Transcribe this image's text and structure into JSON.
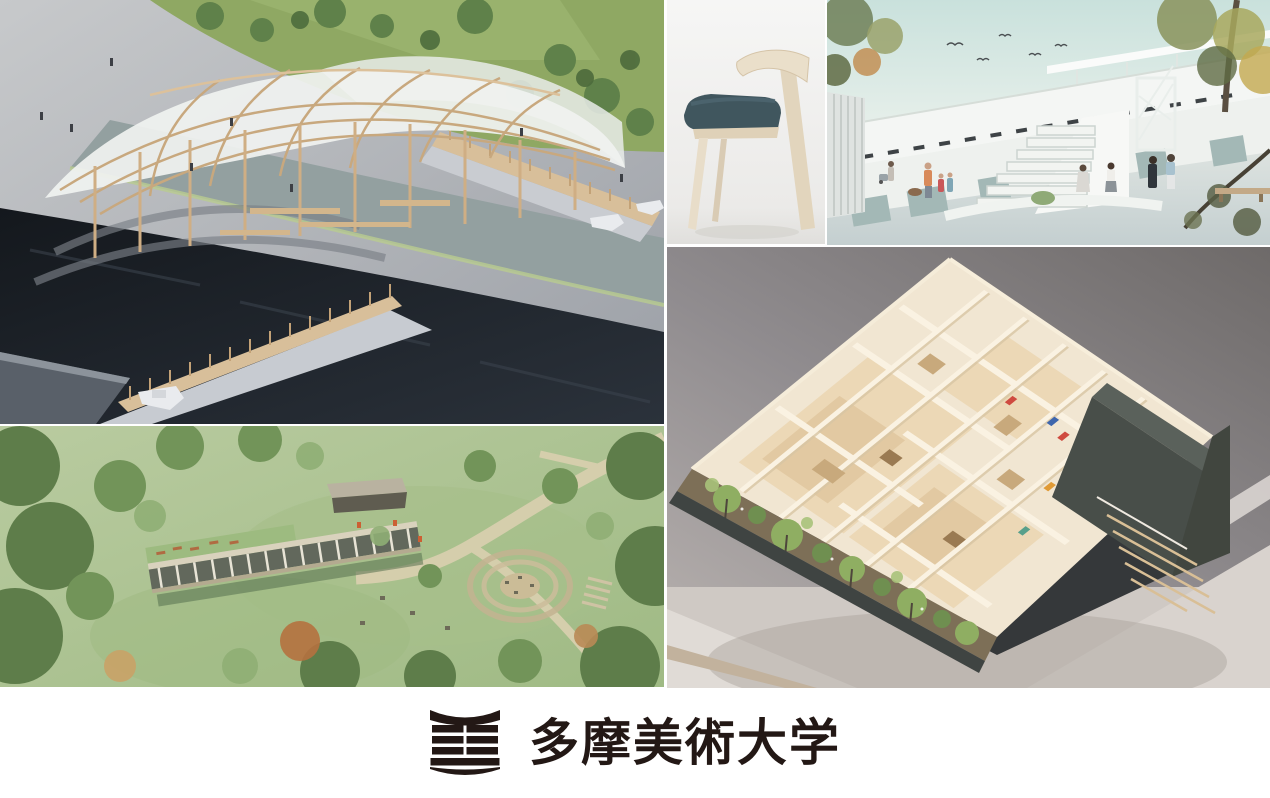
{
  "page": {
    "background_color": "#ffffff"
  },
  "branding": {
    "university_name": "多摩美術大学",
    "logo_color": "#231815"
  },
  "collage": {
    "images": [
      {
        "name": "wooden-pavilion-model",
        "description": "Photo of an architectural model: wooden gridshell pavilion on a gray plaza beside dark water crossed by timber truss bridges with small white boats",
        "dominant_colors": [
          "#a9adb2",
          "#d5bc96",
          "#1c2127",
          "#8fa863"
        ]
      },
      {
        "name": "wooden-chair",
        "description": "Side view photo of a pale wooden chair with a dark teal upholstered seat on a white studio background",
        "dominant_colors": [
          "#f0efed",
          "#e7dcc8",
          "#40565e"
        ]
      },
      {
        "name": "elevated-building-rendering",
        "description": "Rendering of a long white elevated building above an open plaza with grand steps, a spiral stair, trees, birds and people",
        "dominant_colors": [
          "#cde3de",
          "#f2f4f2",
          "#8d9763"
        ]
      },
      {
        "name": "park-aerial-rendering",
        "description": "Aerial rendering of a green park with a colonnade building with planted roof, winding paths and a circular terraced seating area",
        "dominant_colors": [
          "#aec79a",
          "#6d8f58",
          "#d6cdb2"
        ]
      },
      {
        "name": "house-interior-model",
        "description": "Photo of a cutaway architectural model showing cream room walls, pale wood floors, tiny artworks, a planted garden edge and dark outer walls with a timber stair",
        "dominant_colors": [
          "#f1e6d2",
          "#484e49",
          "#8fae62",
          "#6e6a69"
        ]
      }
    ]
  }
}
